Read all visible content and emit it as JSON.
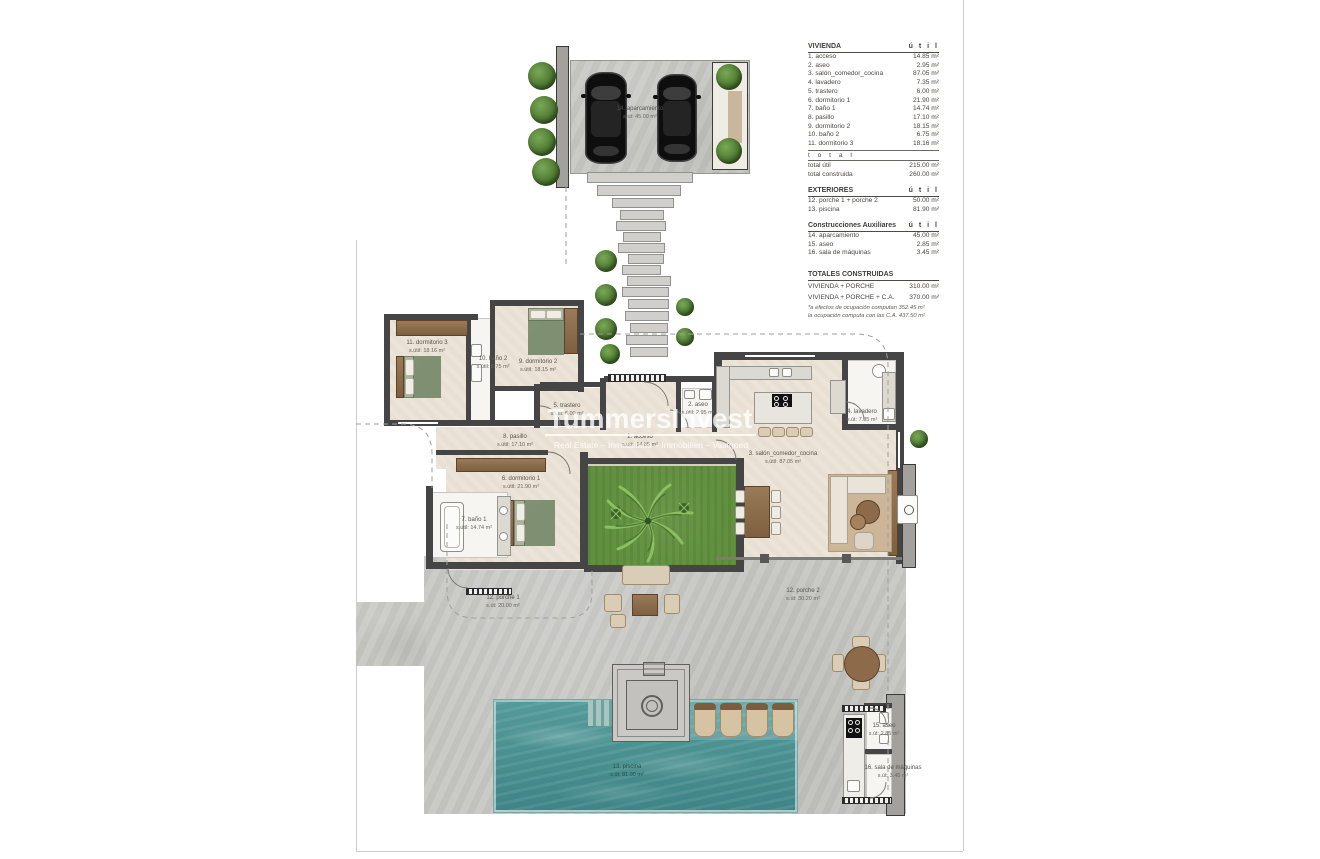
{
  "watermark": {
    "title": "TummersInvest",
    "subtitle": "Real Estate – Inmobiliaria – Immobilien – Vastgoed"
  },
  "legend": {
    "vivienda": {
      "title": "VIVIENDA",
      "col": "ú t i l",
      "rows": [
        [
          "1. acceso",
          "14.85 m²"
        ],
        [
          "2. aseo",
          "2.95 m²"
        ],
        [
          "3. salón_comedor_cocina",
          "87.05 m²"
        ],
        [
          "4. lavadero",
          "7.35 m²"
        ],
        [
          "5. trastero",
          "6.00 m²"
        ],
        [
          "6. dormitorio 1",
          "21.90 m²"
        ],
        [
          "7. baño 1",
          "14.74 m²"
        ],
        [
          "8. pasillo",
          "17.10 m²"
        ],
        [
          "9. dormitorio 2",
          "18.15 m²"
        ],
        [
          "10. baño 2",
          "6.75 m²"
        ],
        [
          "11. dormitorio 3",
          "18.16 m²"
        ]
      ],
      "total_label": "t o t a l",
      "totals": [
        [
          "total útil",
          "215.00 m²"
        ],
        [
          "total construida",
          "260.00 m²"
        ]
      ]
    },
    "exteriores": {
      "title": "EXTERIORES",
      "col": "ú t i l",
      "rows": [
        [
          "12. porche 1 + porche 2",
          "50.00 m²"
        ],
        [
          "13. piscina",
          "81.90 m²"
        ]
      ]
    },
    "auxiliares": {
      "title": "Construcciones Auxiliares",
      "col": "ú t i l",
      "rows": [
        [
          "14. aparcamiento",
          "45.00 m²"
        ],
        [
          "15. aseo",
          "2.85 m²"
        ],
        [
          "16. sala de máquinas",
          "3.45 m²"
        ]
      ]
    },
    "totales": {
      "title": "TOTALES CONSTRUIDAS",
      "rows": [
        [
          "VIVIENDA + PORCHE",
          "310.00 m²"
        ],
        [
          "VIVIENDA + PORCHE + C.A.",
          "370.00 m²"
        ]
      ]
    },
    "footnote1": "*a efectos de ocupación computan 352.45 m²",
    "footnote2": "la ocupación computa con las C.A. 437.50 m²"
  },
  "rooms": {
    "aparcamiento": {
      "name": "14. aparcamiento",
      "area": "s.út: 45.00 m²"
    },
    "dormitorio3": {
      "name": "11. dormitorio 3",
      "area": "s.útil: 18.16 m²"
    },
    "bano2": {
      "name": "10. baño 2",
      "area": "s.útil: 6.75 m²"
    },
    "dormitorio2": {
      "name": "9. dormitorio 2",
      "area": "s.útil: 18.15 m²"
    },
    "trastero": {
      "name": "5. trastero",
      "area": "s.útil: 6.00 m²"
    },
    "pasillo": {
      "name": "8. pasillo",
      "area": "s.útil: 17.10 m²"
    },
    "dormitorio1": {
      "name": "6. dormitorio 1",
      "area": "s.útil: 21.90 m²"
    },
    "bano1": {
      "name": "7. baño 1",
      "area": "s.útil: 14.74 m²"
    },
    "acceso": {
      "name": "1. acceso",
      "area": "s.útil: 14.85 m²"
    },
    "aseo": {
      "name": "2. aseo",
      "area": "s.útil: 2.95 m²"
    },
    "lavadero": {
      "name": "4. lavadero",
      "area": "s.út: 7.35 m²"
    },
    "salon": {
      "name": "3. salón_comedor_cocina",
      "area": "s.útil: 87.05 m²"
    },
    "porche1": {
      "name": "12. porche 1",
      "area": "s.út: 20.00 m²"
    },
    "porche2": {
      "name": "12. porche 2",
      "area": "s.út: 30.20 m²"
    },
    "piscina": {
      "name": "13. piscina",
      "area": "s.út: 81.90 m²"
    },
    "aseo_exterior": {
      "name": "15. aseo",
      "area": "s.út: 2.85 m²"
    },
    "sala_maquinas": {
      "name": "16. sala de máquinas",
      "area": "s.út: 3.45 m²"
    }
  },
  "colors": {
    "wall": "#454545",
    "floor": "#ebe3d6",
    "deck": "#c7c7c4",
    "pool_water": "#4f9597",
    "grass": "#61913e",
    "wood": "#8d6e4f"
  }
}
